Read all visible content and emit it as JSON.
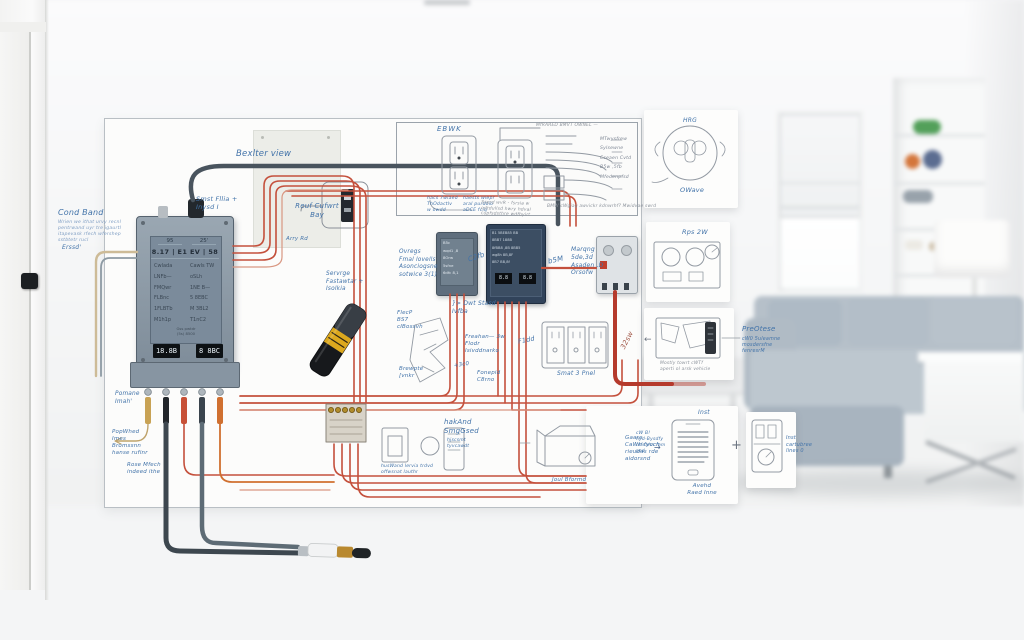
{
  "board": {
    "notes": {
      "cond_band_title": "Cond Band",
      "cond_band_body": "Wrien we ithat urvy recnl\npentrwand uyr tre igaurtl\nitapevask rfech wfershep\nsstbtetr rucl",
      "erssd": "Erssd'",
      "breaker_view": "Bexlter view",
      "smst": "Smst Fllia +\nInysd I",
      "rear_bay": "Reuf Cufwrt\nBay",
      "arry_rd": "Arry Rd",
      "serverge": "Servrge\nFastawtar +\nIsolkia",
      "overgs": "Ovregs\nFmal lovells\nAsonciogsne\nsotwice 3(1)",
      "dwt": "}> Dwt Stasd\n    Ivfba",
      "c2fb": "C2fb",
      "b5m": "b5M",
      "marqng": "Marqng\n5de,3d\nAsaden ,D\nOrsofw",
      "fleck": "FlecP\nBS7\ncIBossvh",
      "brewpte": "Brewpte\n[vnkr",
      "fonepid": "Fonepid\nC8rno",
      "fydd": "F1dd",
      "freshen": "Freahan—   3w\nFlodr\nIsivddnarko",
      "plus3rd": "+3c0",
      "smart_panel": "Smat 3 Pnel",
      "b2sw": "32sw",
      "pomane": "Pomane\nImah'",
      "popwhed": "PopWhed\nImes\nBromssnn\nhanse rufinr",
      "rose_mfech": "Rose Mfech\nindeed ithe",
      "hakand_title": "hakAnd\nSmgGsed",
      "hakand_sub": "hjscsmt\ntyvcawdt",
      "husband": "husWand lervia trdvd\noffwsnat lauthr",
      "jool": "Joul Bformd",
      "gaare": "Gaare\nCaWh fyoch\nrieudas rde\naidorsnd",
      "top_title": "EBWK",
      "outlet_note_1": "hacs 7wlaed\nThOdactlv\nw owdd",
      "outlet_note_2": "haests wiepr\naral purdoio\naDCE fciq",
      "outlet_note_3": "Sserd wvR - fsrsia w\nodtdullsd hwry hdval\ncupfsdsthre wdfbyirt",
      "fan_title": "MfRARED BMVT OWNEL —",
      "fan_labels": "MTwysfrew\nSylsewne\nCseaen Cvtd\nB5w ,5fb\nMfedenpfsd",
      "fan_note": "BMW cWgiag awvickr kdnwrhf? Mwidvae swrd",
      "card1_title": "HRG",
      "card1_caption": "OWave",
      "card2_title": "Rps 2W",
      "preomar_title": "PreOtese",
      "preomar_body": "cW0 5uleamne\nmosdersfne\nfenresrM",
      "floorplan_caption": "Mostly towrt cWTf\naperti ol arsk vehicle",
      "inst_title": "Inst",
      "phone_caption": "Avehd\nRaed Inne",
      "inst_left": "cW B!\nhyd-Bysdfy\nmfeahn fnm\npsd",
      "lower_right_note": "Inst\ncartubree\nlines 0",
      "plus_glyph": "+",
      "arrow_left_glyph": "←",
      "arrow_right_glyph": "→"
    },
    "panel": {
      "header_left": "95",
      "header_right": "25'",
      "row2": "8.17 | E1 EV | 58",
      "rows_left": "Cwlada\nLNFb—\nFMQwr\nFLBnc\n1FLBTb\nM1h1p",
      "rows_right": "Cawls TW\noSLh\n1NE B—\n5 8EBC\nM 3BL2\nT1nC2",
      "display_left": "18.8B",
      "display_right": "8 8BC",
      "footnote": "Gss pwtdr\n(5s)  8500"
    },
    "modules": {
      "small_rows": "B5c\nwqd1 ,8\n8Orw\n5sfne\n6dfc  8,1",
      "big_rows": "B1 5BEB85 BB\n8BB7   188B\n8fBB8 ,8B 8BB5\nwg8h   8B,8F\n8B7   BB,8f",
      "big_win_left": "8.8",
      "big_win_right": "8.8"
    }
  },
  "colors": {
    "wire_red": "#c4503c",
    "wire_red_thick": "#b53a2c",
    "wire_dark": "#49545e",
    "wire_tan": "#c8ab7c",
    "note_blue": "#4273a9",
    "pencil_gray": "#8b929b",
    "panel_body": "#8a99a8",
    "module_dark": "#31435a",
    "marker_yellow": "#dca81e",
    "accent_orange": "#d07030"
  }
}
